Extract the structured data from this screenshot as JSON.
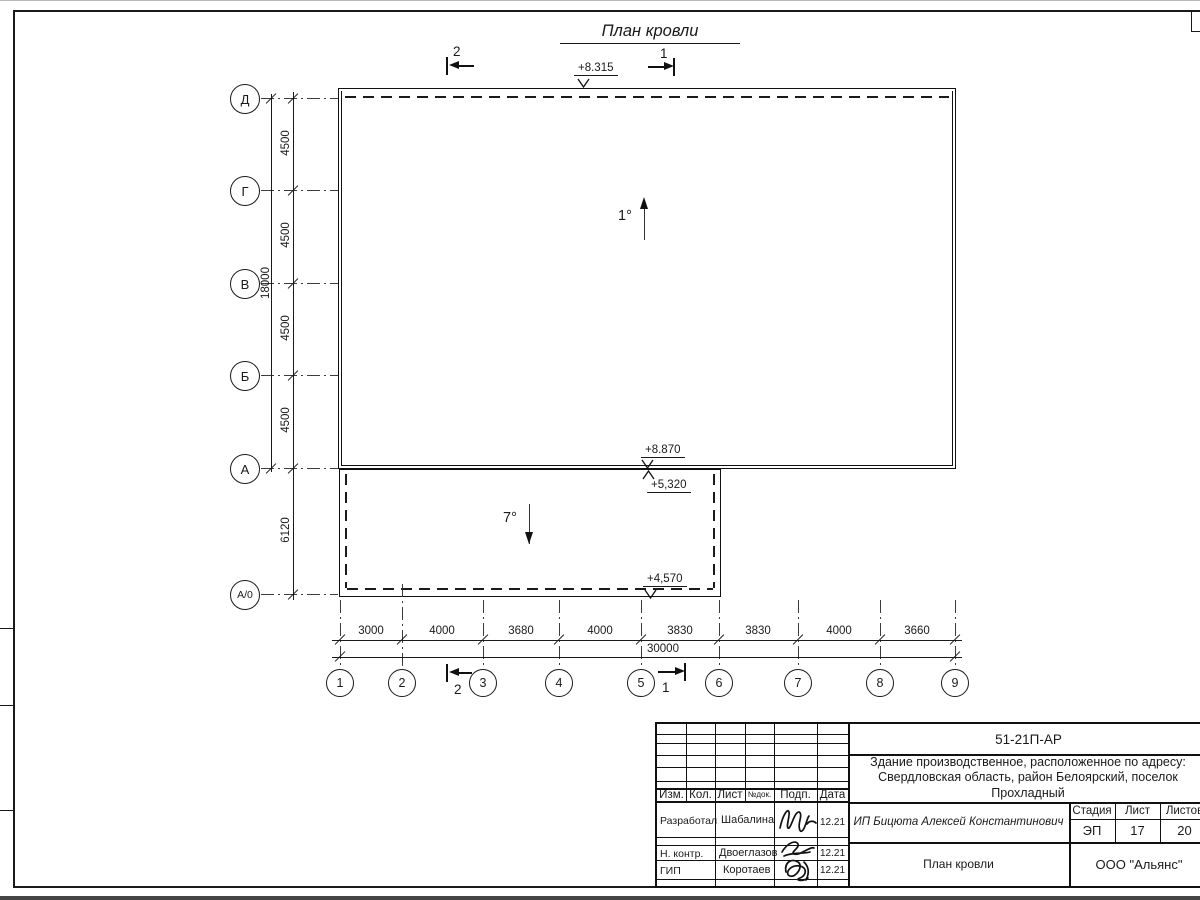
{
  "drawing": {
    "title": "План кровли",
    "elevation_roof_top": "+8.315",
    "elevation_roof_main": "+8.870",
    "elevation_annex_high": "+5,320",
    "elevation_annex_low": "+4,570",
    "slope_main": "1°",
    "slope_annex": "7°",
    "section_1": "1",
    "section_2": "2",
    "row_axes": [
      "Д",
      "Г",
      "В",
      "Б",
      "А",
      "А/0"
    ],
    "col_axes": [
      "1",
      "2",
      "3",
      "4",
      "5",
      "6",
      "7",
      "8",
      "9"
    ],
    "dim_row_segments": [
      "4500",
      "4500",
      "4500",
      "4500",
      "6120"
    ],
    "dim_row_total": "18000",
    "dim_col_segments": [
      "3000",
      "4000",
      "3680",
      "4000",
      "3830",
      "3830",
      "4000",
      "3660"
    ],
    "dim_col_total": "30000"
  },
  "title_block": {
    "doc_number": "51-21П-АР",
    "description": "Здание производственное, расположенное по адресу: Свердловская область, район Белоярский, поселок Прохладный",
    "client": "ИП Бицюта Алексей Константинович",
    "sheet_name": "План кровли",
    "company": "ООО \"Альянс\"",
    "col_izm": "Изм.",
    "col_kol": "Кол.",
    "col_list": "Лист",
    "col_doc": "№док.",
    "col_sign": "Подп.",
    "col_date": "Дата",
    "stage_label": "Стадия",
    "sheet_label": "Лист",
    "sheets_label": "Листов",
    "stage": "ЭП",
    "sheet_no": "17",
    "sheets_total": "20",
    "roles": [
      {
        "role": "Разработал",
        "name": "Шабалина",
        "date": "12.21"
      },
      {
        "role": "Н. контр.",
        "name": "Двоеглазов",
        "date": "12.21"
      },
      {
        "role": "ГИП",
        "name": "Коротаев",
        "date": "12.21"
      }
    ]
  }
}
